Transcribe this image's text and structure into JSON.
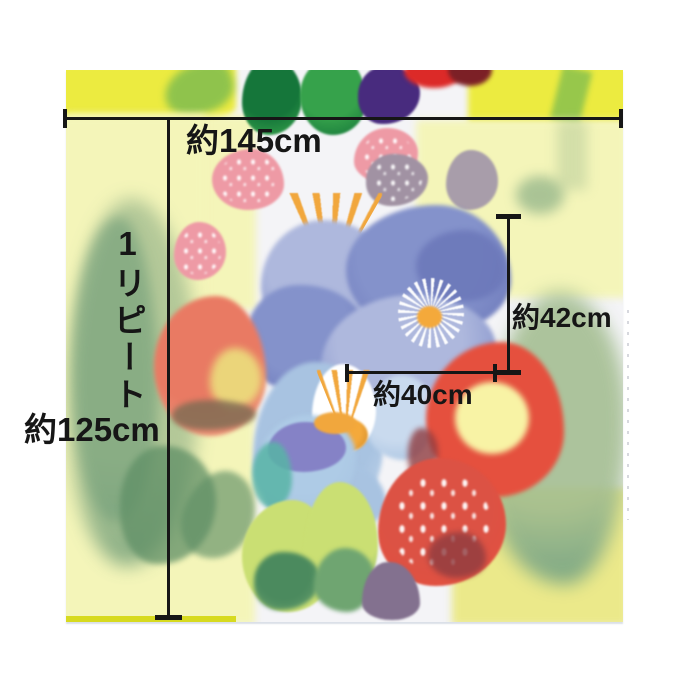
{
  "figure": {
    "description": "Watercolor floral fabric panel photographed flat, annotated with dimension lines",
    "background": "#ffffff"
  },
  "annotations": {
    "fabric_width": {
      "label": "約145cm"
    },
    "repeat": {
      "label": "1リピート"
    },
    "repeat_height": {
      "label": "約125cm"
    },
    "motif_height": {
      "label": "約42cm"
    },
    "motif_width": {
      "label": "約40cm"
    }
  },
  "style": {
    "line_color": "#161616",
    "text_color": "#161616"
  },
  "palette": {
    "base": "#f4f4f7",
    "yellowBright": "#eceb40",
    "yellowPale": "#f4f5b9",
    "yellowWarm": "#ebe98a",
    "chartreuse": "#d7da1f",
    "greenLeafDark": "#15763a",
    "greenLeaf": "#36a24b",
    "greenStreak": "#44a457",
    "sage": "#a3bd90",
    "sageDark": "#6e9c78",
    "teal": "#679b82",
    "leafDark": "#5f8f66",
    "purpleDeep": "#482b7e",
    "redTop": "#dc2a28",
    "maroonTop": "#7c2026",
    "berryPink": "#ee9aa5",
    "berryMauve": "#a192a3",
    "mauve": "#a89daa",
    "orange": "#f1a73d",
    "orangeDeep": "#cf8c2b",
    "periwinkle": "#8492cb",
    "periwinkleLight": "#aeb8dd",
    "periwinkleDark": "#6b77b9",
    "blueLight": "#a8c3e1",
    "blueLighter": "#c9daee",
    "daisyCenter": "#f4a93b",
    "coral": "#e97a63",
    "coralLight": "#f09a7f",
    "yellowCore": "#ecdf7d",
    "roseOlive": "#7a6b52",
    "poppyRed": "#e5503e",
    "poppyCenter": "#f8f3a5",
    "dottedRed": "#dc5244",
    "maroonPatch": "#8f3c40",
    "lime": "#cadf73",
    "limeGreen": "#6fa571",
    "greenDeep": "#4b8a5e",
    "plum": "#83718f",
    "speckBlue": "#aecbe6",
    "speckPurple": "#7b70bf",
    "tealAccent": "#58b4a6",
    "white": "#ffffff"
  }
}
